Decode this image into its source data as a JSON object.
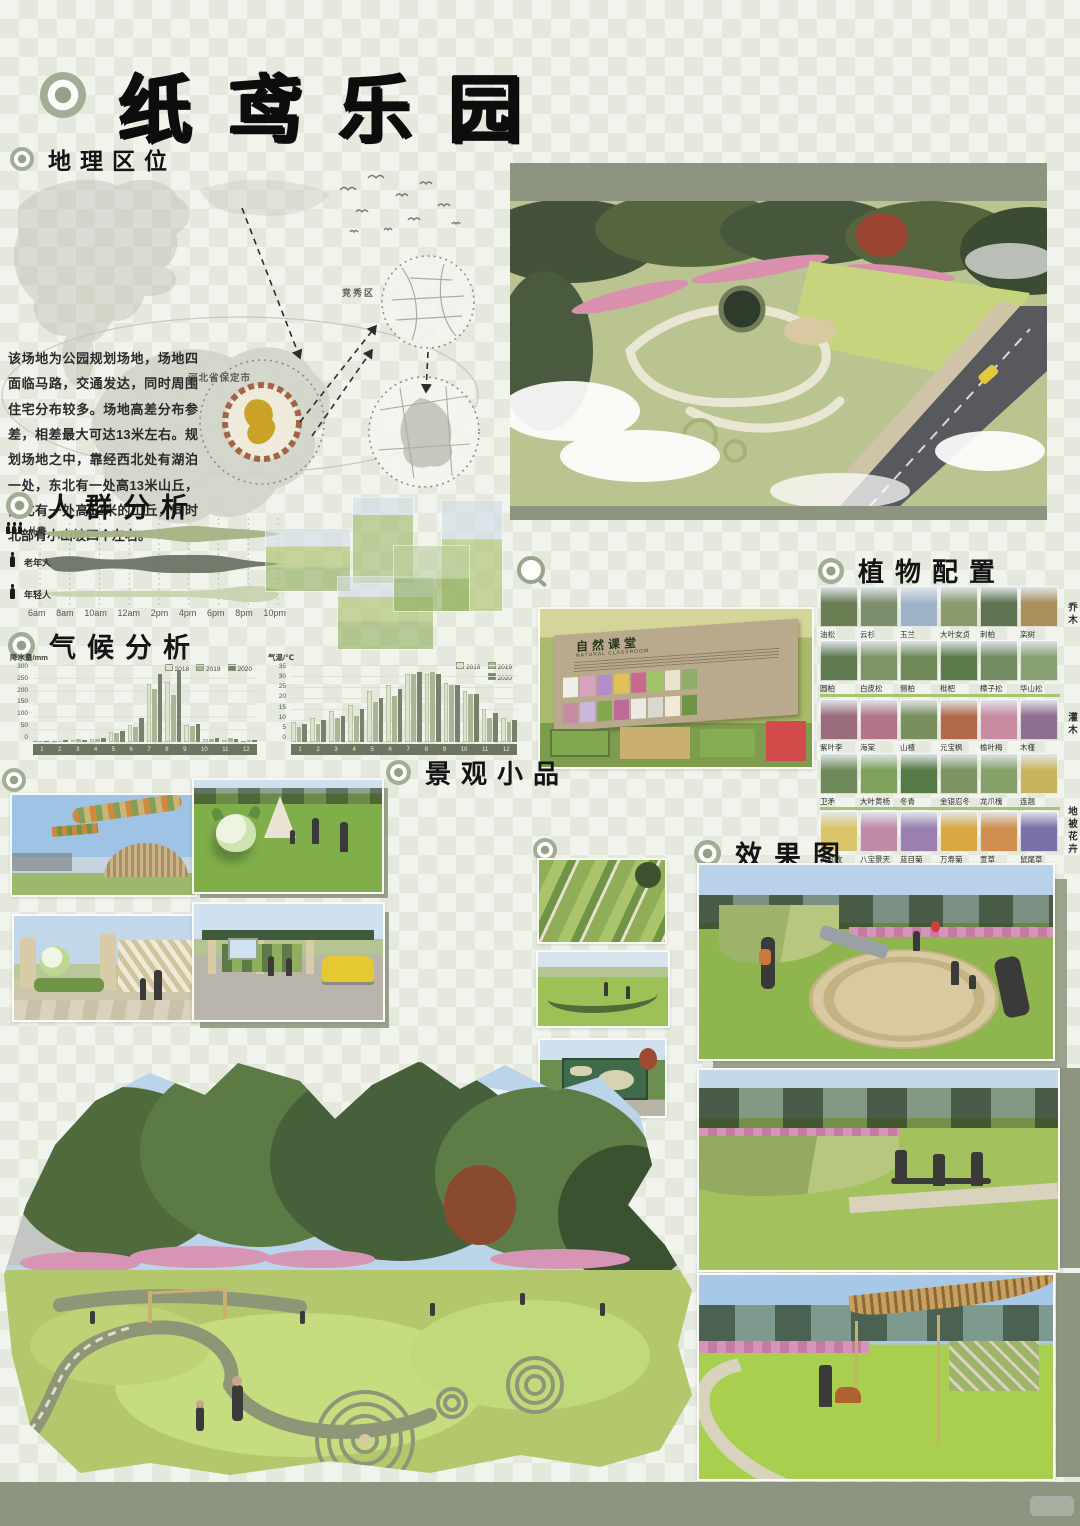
{
  "header": {
    "title": "纸鸢乐园"
  },
  "sections": {
    "geo": {
      "heading": "地理区位",
      "paragraph": "该场地为公园规划场地，场地四面临马路，交通发达，同时周围住宅分布较多。场地高差分布参差，相差最大可达13米左右。规划场地之中，靠经西北处有湖泊一处，东北有一处高13米山丘，西北有一处高12米的山丘，同时北部有小山坡四个左右。",
      "city_label": "河北省保定市",
      "district_label": "竞秀区"
    },
    "crowd": {
      "heading": "人群分析",
      "groups": [
        "儿童",
        "老年人",
        "年轻人"
      ],
      "times": [
        "6am",
        "8am",
        "10am",
        "12am",
        "2pm",
        "4pm",
        "6pm",
        "8pm",
        "10pm"
      ]
    },
    "climate": {
      "heading": "气候分析"
    },
    "scenery": {
      "heading": "景观小品"
    },
    "plants": {
      "heading": "植物配置"
    },
    "effect": {
      "heading": "效果图"
    },
    "sign": {
      "title": "自然课堂",
      "subtitle": "NATURAL CLASSROOM"
    }
  },
  "plants": {
    "categories": [
      "乔木",
      "灌木",
      "地被花卉"
    ],
    "rows": [
      {
        "items": [
          {
            "name": "油松",
            "color": "#6b7d52"
          },
          {
            "name": "云杉",
            "color": "#7c8f6a"
          },
          {
            "name": "玉兰",
            "color": "#9fb3c8"
          },
          {
            "name": "大叶女贞",
            "color": "#8a9a6b"
          },
          {
            "name": "刺柏",
            "color": "#5e7350"
          },
          {
            "name": "栾树",
            "color": "#a98f5a"
          }
        ]
      },
      {
        "items": [
          {
            "name": "圆柏",
            "color": "#5f7a4e"
          },
          {
            "name": "白皮松",
            "color": "#7e9468"
          },
          {
            "name": "侧柏",
            "color": "#6f8a58"
          },
          {
            "name": "枇杷",
            "color": "#5c7a4a"
          },
          {
            "name": "樟子松",
            "color": "#708c60"
          },
          {
            "name": "华山松",
            "color": "#87a074"
          }
        ]
      },
      {
        "items": [
          {
            "name": "紫叶李",
            "color": "#9a6b7a"
          },
          {
            "name": "海棠",
            "color": "#b07688"
          },
          {
            "name": "山楂",
            "color": "#7a8f5e"
          },
          {
            "name": "元宝枫",
            "color": "#b06a4a"
          },
          {
            "name": "榆叶梅",
            "color": "#c78ba2"
          },
          {
            "name": "木槿",
            "color": "#8f6f8f"
          }
        ]
      },
      {
        "items": [
          {
            "name": "卫矛",
            "color": "#6f8a5a"
          },
          {
            "name": "大叶黄杨",
            "color": "#7fa25a"
          },
          {
            "name": "冬青",
            "color": "#567a46"
          },
          {
            "name": "金银忍冬",
            "color": "#7d9460"
          },
          {
            "name": "龙爪槐",
            "color": "#86a06a"
          },
          {
            "name": "连翘",
            "color": "#c9b45e"
          }
        ]
      },
      {
        "items": [
          {
            "name": "黄刺玫",
            "color": "#d9c56a"
          },
          {
            "name": "八宝景天",
            "color": "#c08ba6"
          },
          {
            "name": "蓝目菊",
            "color": "#9a7fb0"
          },
          {
            "name": "万寿菊",
            "color": "#d9a843"
          },
          {
            "name": "萱草",
            "color": "#cf8f4e"
          },
          {
            "name": "鼠尾草",
            "color": "#7a6fa8"
          }
        ]
      }
    ]
  },
  "chart_data": [
    {
      "type": "area",
      "title": "人群分析 - 活动时段分布",
      "categories": [
        "6am",
        "8am",
        "10am",
        "12am",
        "2pm",
        "4pm",
        "6pm",
        "8pm",
        "10pm"
      ],
      "series": [
        {
          "name": "儿童",
          "color": "#a7b285",
          "values": [
            0,
            3,
            2,
            2,
            3,
            6,
            4,
            3,
            1
          ]
        },
        {
          "name": "老年人",
          "color": "#6e7566",
          "values": [
            3,
            6,
            3,
            3,
            6,
            6,
            6,
            2,
            0
          ]
        },
        {
          "name": "年轻人",
          "color": "#c9d2b0",
          "values": [
            1,
            2,
            2,
            2,
            2,
            2,
            3,
            6,
            4
          ]
        }
      ],
      "xlabel": "时间",
      "ylabel": "活动强度(相对)"
    },
    {
      "type": "bar",
      "title": "降水量",
      "ylabel": "降水量/mm",
      "categories": [
        "1",
        "2",
        "3",
        "4",
        "5",
        "6",
        "7",
        "8",
        "9",
        "10",
        "11",
        "12"
      ],
      "yticks": [
        "300",
        "250",
        "200",
        "150",
        "100",
        "50",
        "0"
      ],
      "ylim": [
        0,
        300
      ],
      "series": [
        {
          "name": "2018",
          "color": "#dfe3cc",
          "values": [
            3,
            5,
            8,
            12,
            40,
            65,
            225,
            235,
            68,
            12,
            8,
            5
          ]
        },
        {
          "name": "2019",
          "color": "#aab593",
          "values": [
            2,
            4,
            10,
            10,
            35,
            60,
            205,
            185,
            62,
            10,
            15,
            8
          ]
        },
        {
          "name": "2020",
          "color": "#78816c",
          "values": [
            4,
            6,
            9,
            14,
            42,
            95,
            265,
            280,
            72,
            14,
            12,
            6
          ]
        }
      ],
      "legend_position": "top-right",
      "grid": true
    },
    {
      "type": "bar",
      "title": "气温",
      "ylabel": "气温/℃",
      "categories": [
        "1",
        "2",
        "3",
        "4",
        "5",
        "6",
        "7",
        "8",
        "9",
        "10",
        "11",
        "12"
      ],
      "yticks": [
        "35",
        "30",
        "25",
        "20",
        "15",
        "10",
        "5",
        "0"
      ],
      "ylim": [
        0,
        35
      ],
      "series": [
        {
          "name": "2018",
          "color": "#dfe3cc",
          "values": [
            9,
            11,
            14,
            17,
            23,
            26,
            31,
            31,
            27,
            23,
            15,
            11
          ]
        },
        {
          "name": "2019",
          "color": "#aab593",
          "values": [
            7,
            8,
            11,
            12,
            18,
            21,
            31,
            32,
            26,
            22,
            11,
            9
          ]
        },
        {
          "name": "2020",
          "color": "#78816c",
          "values": [
            8,
            10,
            12,
            15,
            20,
            24,
            32,
            31,
            26,
            22,
            13,
            10
          ]
        }
      ],
      "legend_position": "top-right",
      "grid": true
    }
  ],
  "colors": {
    "sage_accent": "#8d9480",
    "divider_green": "#a6c56e",
    "title_black": "#0d0d0d"
  }
}
